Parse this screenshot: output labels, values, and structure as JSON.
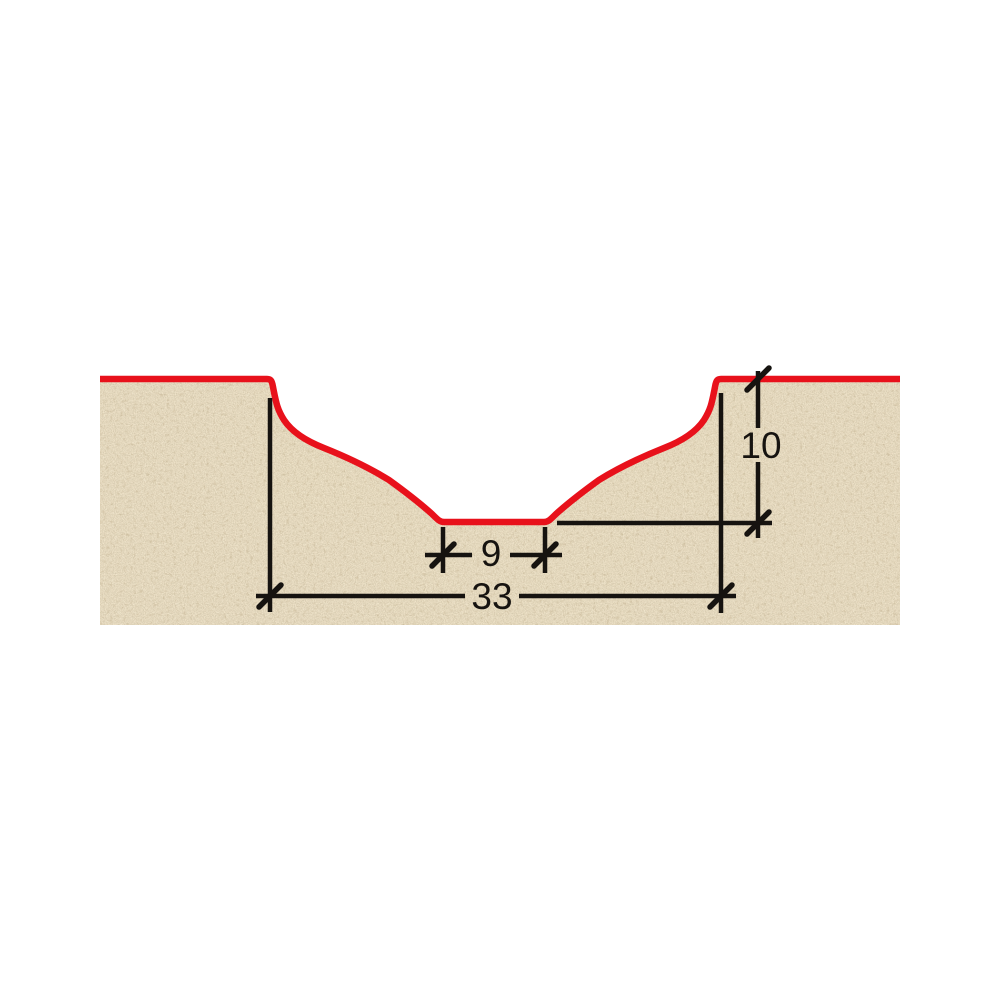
{
  "dimensions": {
    "bottom_width": "9",
    "overall_width": "33",
    "depth": "10"
  },
  "colors": {
    "profile": "#e8111b",
    "board_base": "#cfba8f",
    "dimension": "#161310",
    "text": "#161310",
    "background": "#ffffff"
  }
}
